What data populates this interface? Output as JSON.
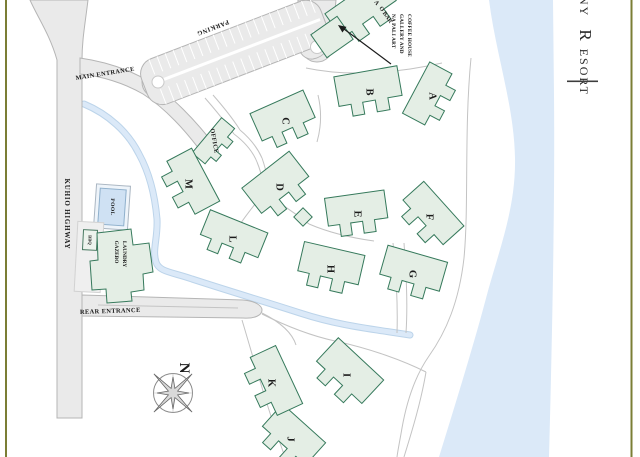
{
  "title": {
    "visible_text": "NY RESORT",
    "parts": [
      "NY",
      "R",
      "ESORT"
    ]
  },
  "map": {
    "roads": {
      "kuhio_highway_label": "KUHIO HIGHWAY",
      "main_entrance_label": "MAIN ENTRANCE",
      "rear_entrance_label": "REAR ENTRANCE",
      "parking_label": "PARKING"
    },
    "amenities": {
      "office_label": "OFFICE",
      "pool_label": "POOL",
      "bbq_label": "BBQ",
      "gazebo_line1": "GAZEBO",
      "gazebo_line2": "LAUNDRY"
    },
    "annotations": {
      "bar_line1": "A",
      "bar_line2": "O BAR",
      "gallery_line1": "NA PALI ART",
      "gallery_line2": "GALLERY AND",
      "gallery_line3": "COFFEE HOUSE"
    },
    "compass": {
      "north_label": "N"
    },
    "buildings": [
      {
        "label": "A",
        "cx": 432,
        "cy": 96,
        "rot": -62,
        "w": 58,
        "h": 36
      },
      {
        "label": "B",
        "cx": 369,
        "cy": 92,
        "rot": -10,
        "w": 64,
        "h": 42
      },
      {
        "label": "C",
        "cx": 285,
        "cy": 121,
        "rot": -24,
        "w": 58,
        "h": 42
      },
      {
        "label": "D",
        "cx": 279,
        "cy": 187,
        "rot": -38,
        "w": 60,
        "h": 44
      },
      {
        "label": "E",
        "cx": 357,
        "cy": 214,
        "rot": -8,
        "w": 60,
        "h": 40
      },
      {
        "label": "F",
        "cx": 429,
        "cy": 217,
        "rot": 48,
        "w": 60,
        "h": 40
      },
      {
        "label": "G",
        "cx": 412,
        "cy": 274,
        "rot": 16,
        "w": 62,
        "h": 42
      },
      {
        "label": "H",
        "cx": 330,
        "cy": 269,
        "rot": 13,
        "w": 62,
        "h": 42
      },
      {
        "label": "I",
        "cx": 346,
        "cy": 375,
        "rot": 43,
        "w": 62,
        "h": 44
      },
      {
        "label": "J",
        "cx": 290,
        "cy": 439,
        "rot": 42,
        "w": 58,
        "h": 42
      },
      {
        "label": "K",
        "cx": 271,
        "cy": 383,
        "rot": 65,
        "w": 64,
        "h": 40
      },
      {
        "label": "L",
        "cx": 232,
        "cy": 239,
        "rot": 22,
        "w": 62,
        "h": 38
      },
      {
        "label": "M",
        "cx": 188,
        "cy": 184,
        "rot": 62,
        "w": 60,
        "h": 40
      }
    ],
    "colors": {
      "building_fill": "#e4eee5",
      "building_stroke": "#35795b",
      "water_fill": "#dbe9f8",
      "stream_core": "#dbe9f8",
      "stream_edge": "#bcd4ea",
      "road_fill": "#eaeaea",
      "road_stroke": "#b5b5b5",
      "pool_fill": "#cfe1f3",
      "frame_color": "#7b7e35"
    }
  }
}
